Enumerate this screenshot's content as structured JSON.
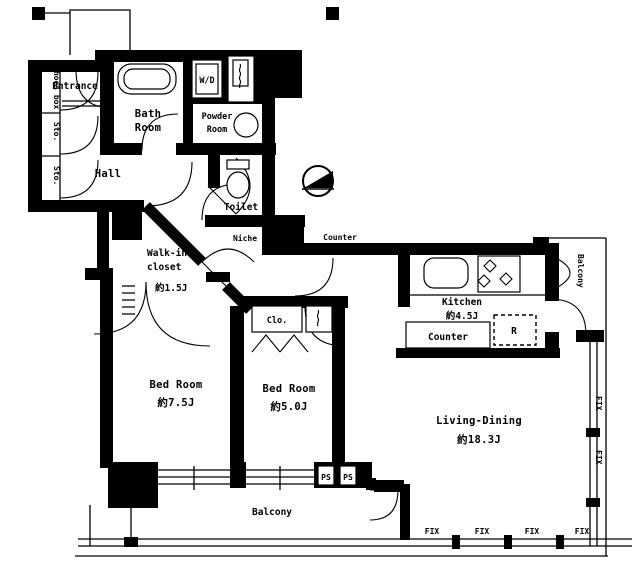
{
  "plan": {
    "type": "apartment-floor-plan",
    "colors": {
      "wall": "#000000",
      "background": "#ffffff"
    },
    "labels": {
      "entrance": "Entrance",
      "shoes_box": "Shoes box",
      "sto_1": "Sto.",
      "sto_2": "Sto.",
      "bath_room_line1": "Bath",
      "bath_room_line2": "Room",
      "washer_dryer": "W/D",
      "powder_room_line1": "Powder",
      "powder_room_line2": "Room",
      "hall": "Hall",
      "toilet": "Toilet",
      "niche": "Niche",
      "walk_in_closet_line1": "Walk-in",
      "walk_in_closet_line2": "closet",
      "walk_in_closet_size": "約1.5J",
      "counter_top": "Counter",
      "kitchen": "Kitchen",
      "kitchen_size": "約4.5J",
      "kitchen_counter": "Counter",
      "refrigerator": "R",
      "closet": "Clo.",
      "bed_room_1": "Bed Room",
      "bed_room_1_size": "約7.5J",
      "bed_room_2": "Bed Room",
      "bed_room_2_size": "約5.0J",
      "living_dining": "Living-Dining",
      "living_dining_size": "約18.3J",
      "balcony_bottom": "Balcony",
      "balcony_right": "Balcony",
      "ps_1": "PS",
      "ps_2": "PS",
      "fix": "FIX"
    }
  }
}
